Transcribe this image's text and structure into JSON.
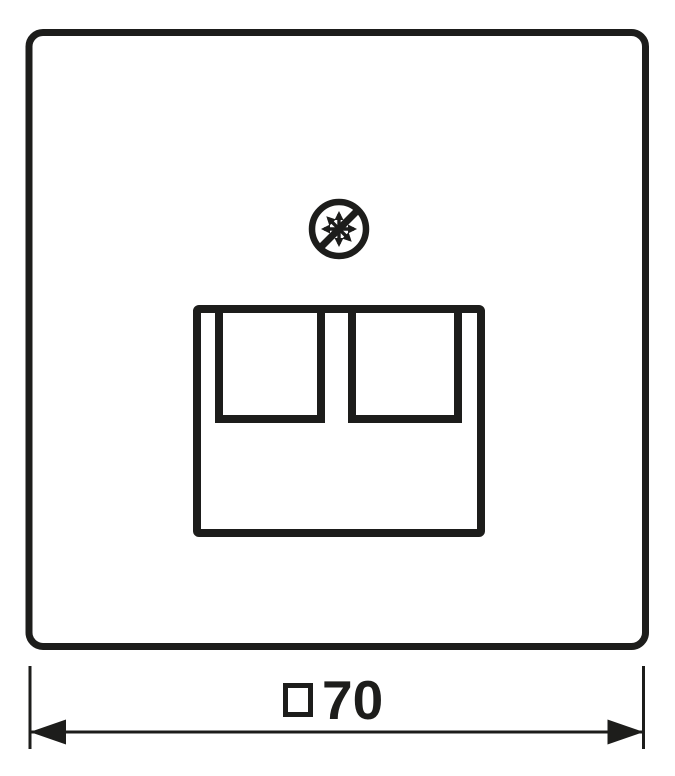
{
  "colors": {
    "ink": "#1d1d1b",
    "background": "#ffffff"
  },
  "icons": {
    "prohibition_asterisk_icon": "crossed-out asterisk inside circle (no-symbol over star of arrows)"
  },
  "drawing": {
    "plate_shape": "rounded-square cover plate, front view",
    "socket": {
      "ports": 2,
      "description": "two square jack openings hanging from top edge of socket frame"
    }
  },
  "dimension": {
    "label": "□70",
    "symbol": "□",
    "value": "70"
  }
}
